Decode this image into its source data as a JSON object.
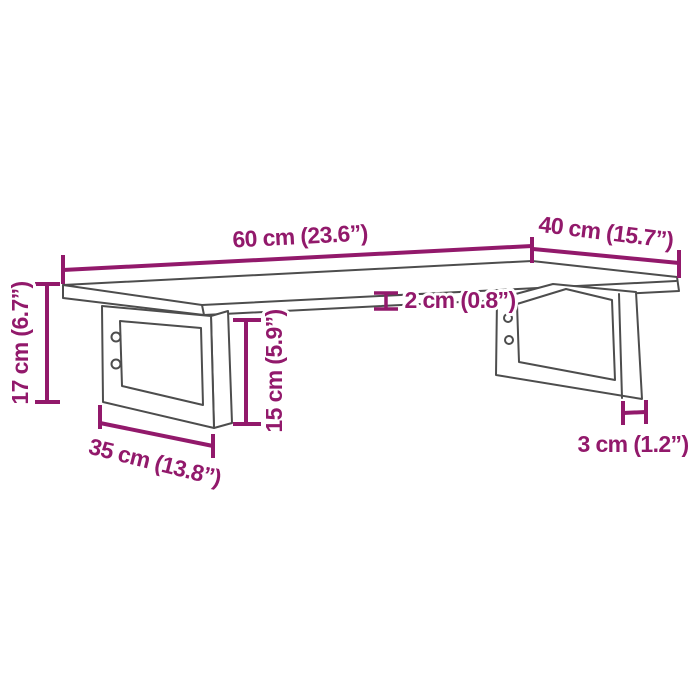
{
  "figure": {
    "background": "#ffffff",
    "colors": {
      "dimension_accent": "#92196B",
      "drawing_outline": "#4d4d4d"
    },
    "labels": {
      "top_width": "60 cm (23.6”)",
      "top_depth": "40 cm (15.7”)",
      "top_thickness": "2 cm (0.8”)",
      "overall_height": "17 cm (6.7”)",
      "bracket_height": "15 cm (5.9”)",
      "bracket_depth": "35 cm (13.8”)",
      "bracket_bar_width": "3 cm (1.2”)"
    }
  }
}
